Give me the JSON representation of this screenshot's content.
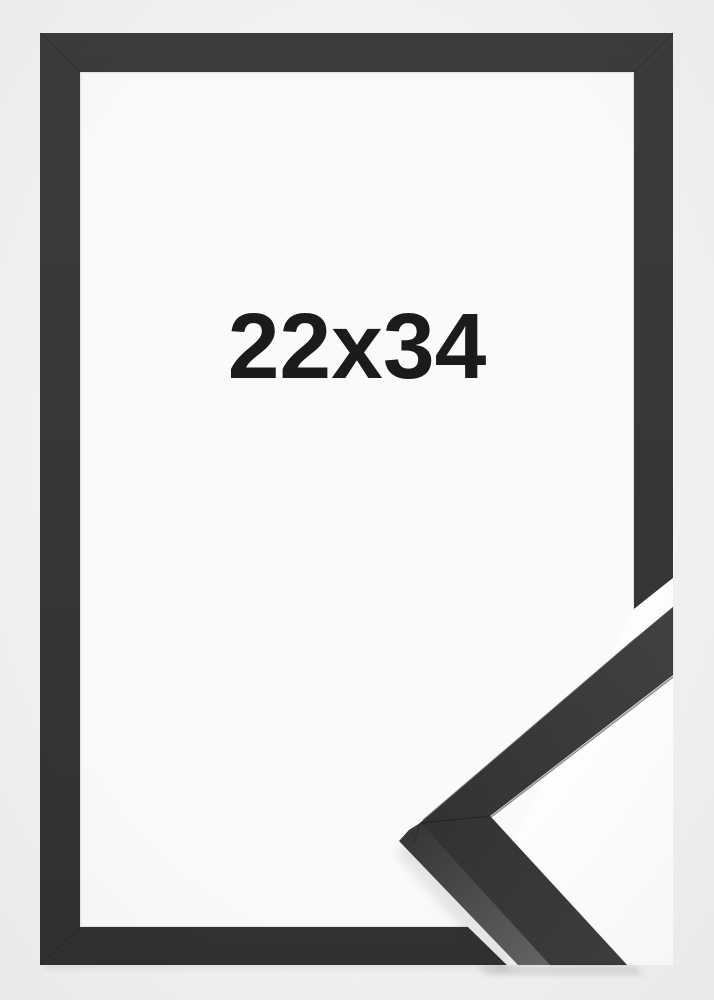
{
  "product": {
    "size_label": "22x34"
  },
  "colors": {
    "background": "#f1f1f2",
    "paper": "#fafafa",
    "overlay_white": "#fdfdfe",
    "frame_top": "#3a3c3e",
    "frame_bottom": "#2f3133",
    "sample_face_light": "#434547",
    "sample_face_dark": "#303234",
    "sample_side_light": "#616365",
    "sample_side_dark": "#343638",
    "vertex_facet": "#2b2d2f",
    "text": "#1b1b1b"
  }
}
